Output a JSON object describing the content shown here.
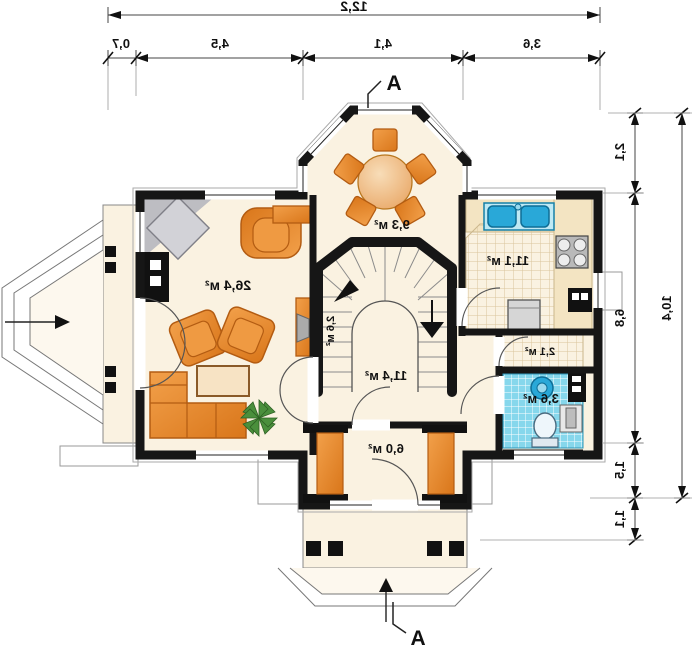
{
  "plan": {
    "kind": "ground-floor-plan",
    "mirrored": true,
    "section_marker_top": "A",
    "section_marker_bottom": "A"
  },
  "dimensions": {
    "top": {
      "total": "12,2",
      "seg0": "0,7",
      "seg1": "4,5",
      "seg2": "4,1",
      "seg3": "3,6"
    },
    "right": {
      "total": "10,4",
      "seg0": "2,1",
      "seg1": "6,8",
      "seg2": "1,5",
      "seg3": "1,1"
    }
  },
  "rooms": {
    "living": {
      "label": "26,4 м²"
    },
    "dining": {
      "label": "9,3 м²"
    },
    "kitchen": {
      "label": "11,1 м²"
    },
    "stairs": {
      "label": "2,6 м²"
    },
    "hall": {
      "label": "11,4 м²"
    },
    "pantry": {
      "label": "2,1 м²"
    },
    "bathroom": {
      "label": "3,6 м²"
    },
    "vestibule": {
      "label": "6,0 м²"
    }
  },
  "colors": {
    "wall": "#161616",
    "floor": "#faf2e1",
    "furniture_orange": "#e8872b",
    "bath_tile": "#86d7ec",
    "fixture_blue": "#29a8d8",
    "fireplace_gray": "#c9c9cd"
  }
}
